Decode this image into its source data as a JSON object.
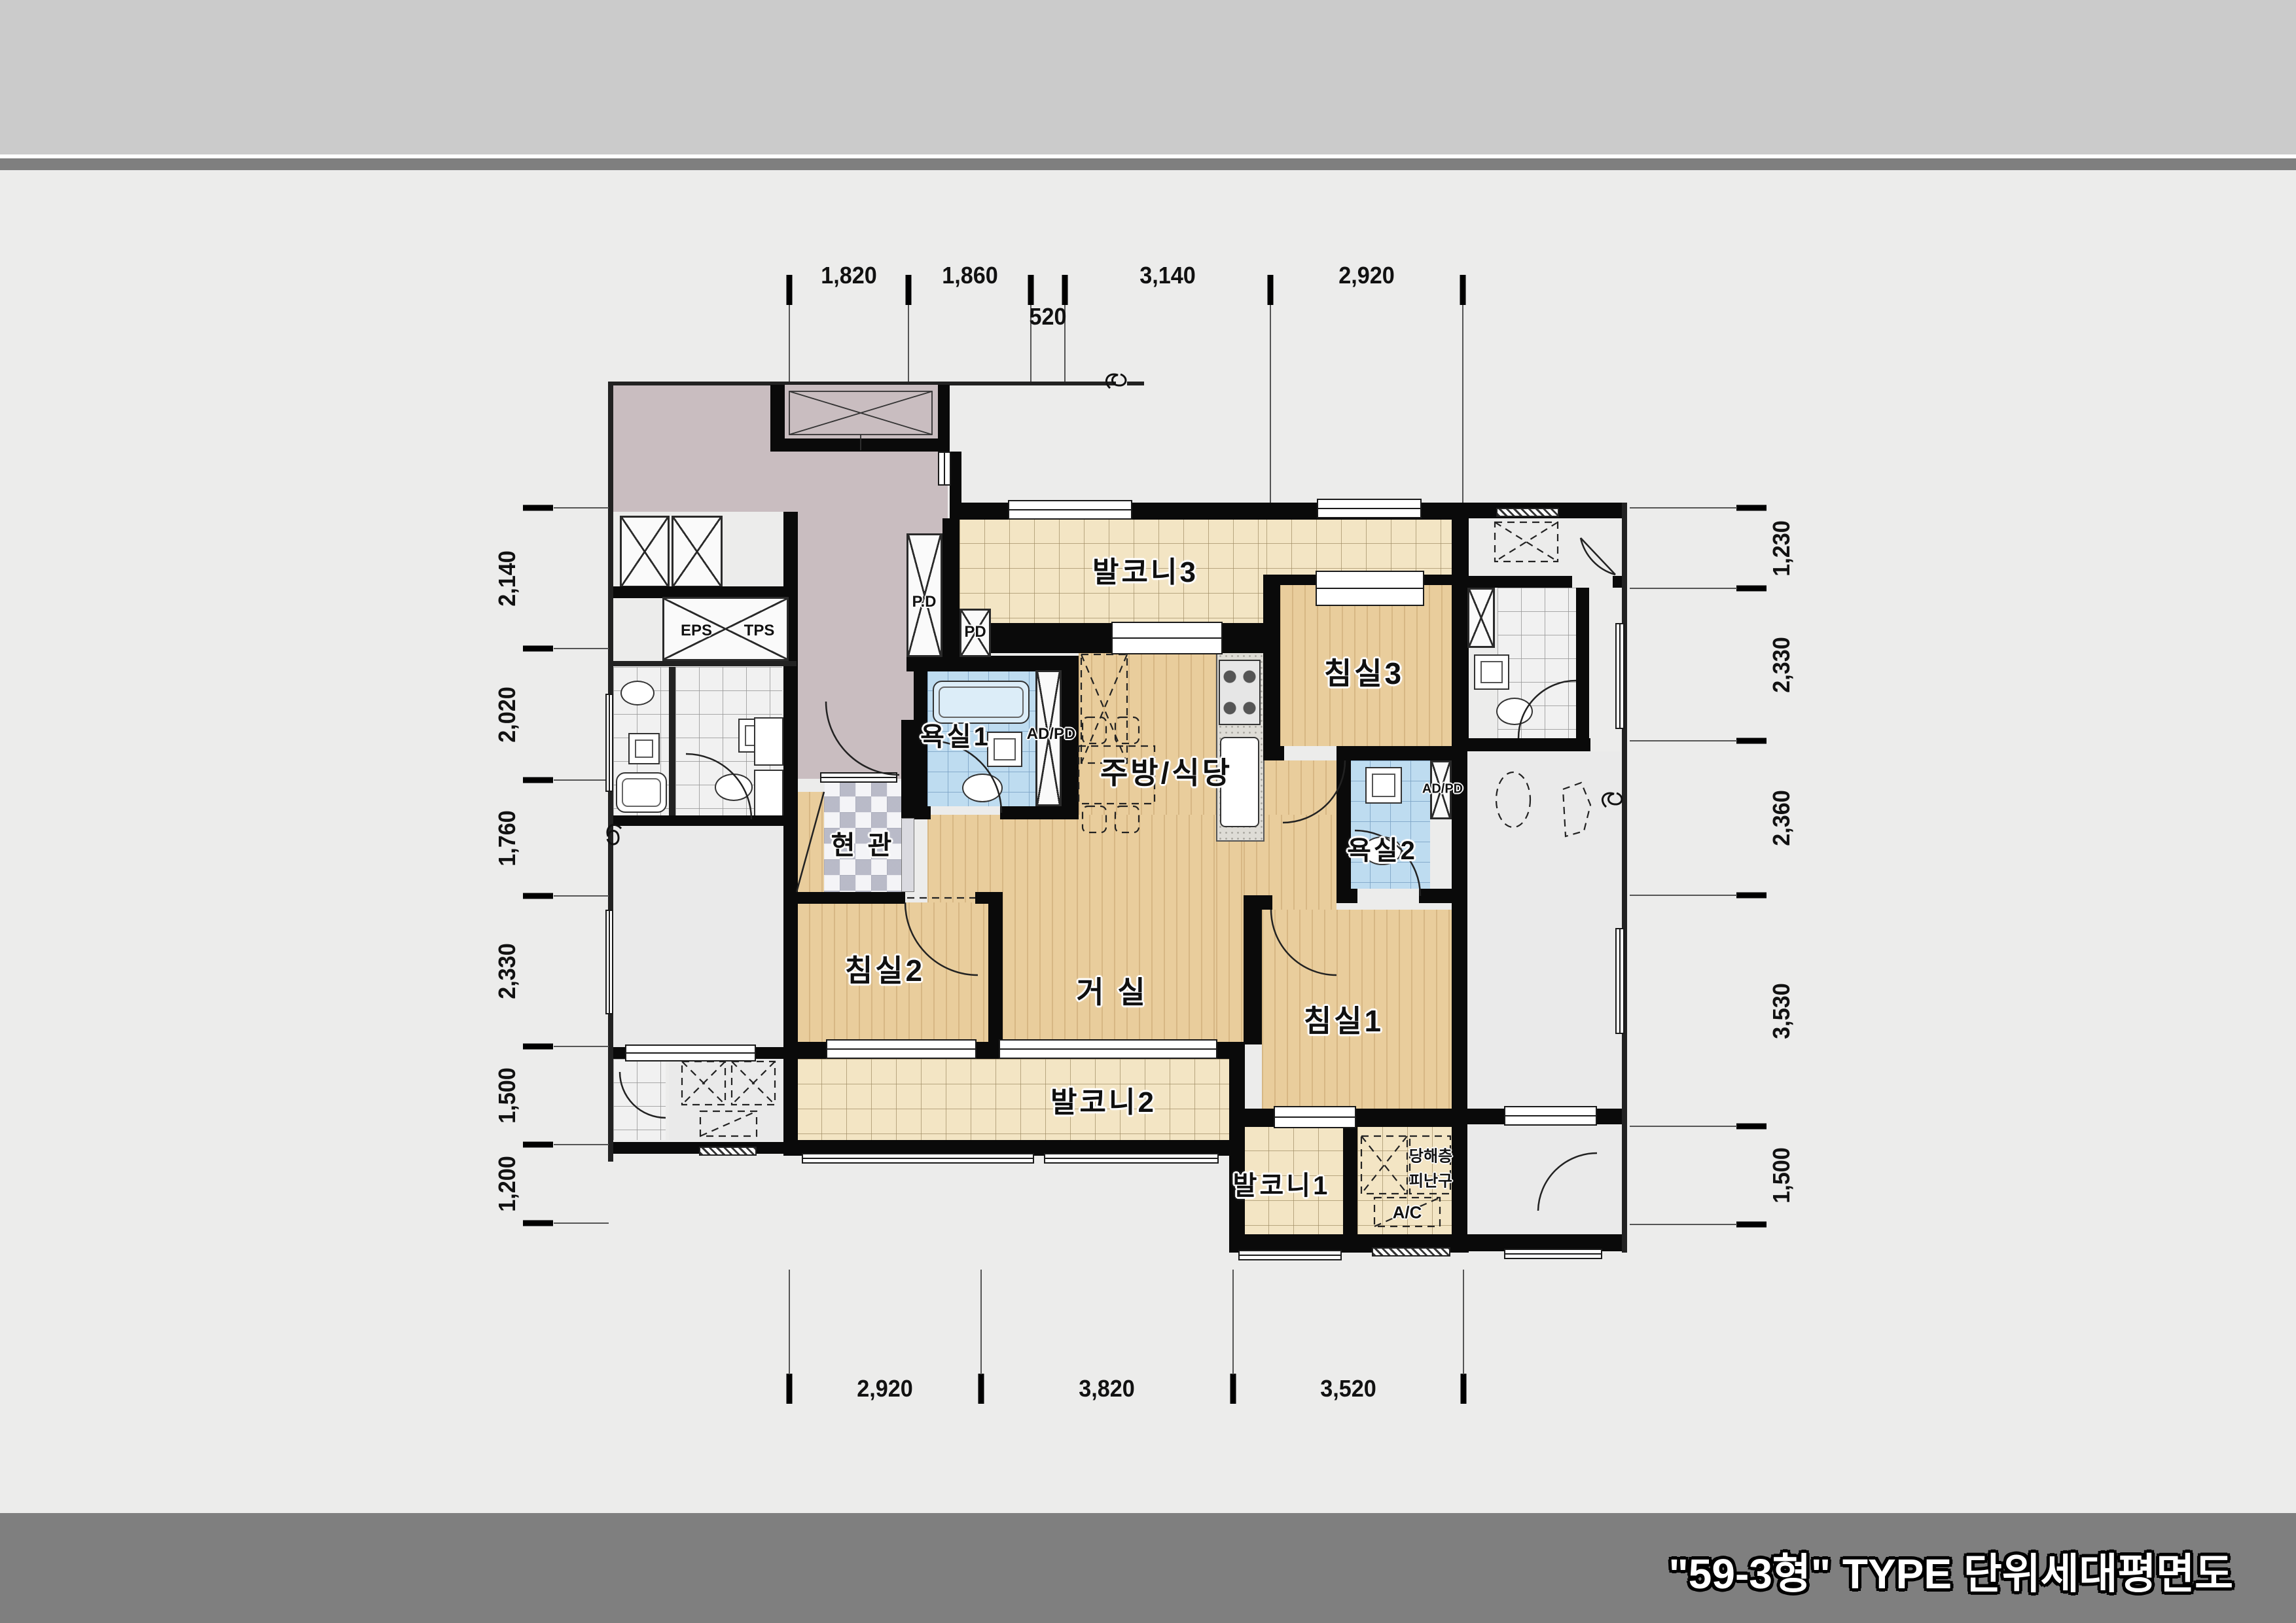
{
  "title": "\"59-3형\" TYPE 단위세대평면도",
  "dims": {
    "top": [
      "1,820",
      "1,860",
      "520",
      "3,140",
      "2,920"
    ],
    "left": [
      "2,140",
      "2,020",
      "1,760",
      "2,330",
      "1,500",
      "1,200"
    ],
    "right": [
      "1,230",
      "2,330",
      "2,360",
      "3,530",
      "1,500"
    ],
    "bottom": [
      "2,920",
      "3,820",
      "3,520"
    ]
  },
  "rooms": {
    "balcony3": "발코니3",
    "kitchen_dining": "주방/식당",
    "bedroom3": "침실3",
    "bath1": "욕실1",
    "bath2": "욕실2",
    "entry": "현 관",
    "bedroom2": "침실2",
    "living": "거 실",
    "bedroom1": "침실1",
    "balcony2": "발코니2",
    "balcony1": "발코니1"
  },
  "labels": {
    "eps": "EPS",
    "tps": "TPS",
    "pd_large": "P.D",
    "pd_small": "PD",
    "adpd_bath1": "AD/PD",
    "adpd_bath2": "AD/PD",
    "ac": "A/C",
    "hatch_line1": "당해층",
    "hatch_line2": "피난구"
  },
  "colors": {
    "wall": "#0a0a0a",
    "wood_floor": "#e9cd9c",
    "balcony_tile": "#f3e5c4",
    "bath_tile": "#bedcf0",
    "corridor": "#c9bdc0",
    "band_gray": "#7f7f7f"
  }
}
